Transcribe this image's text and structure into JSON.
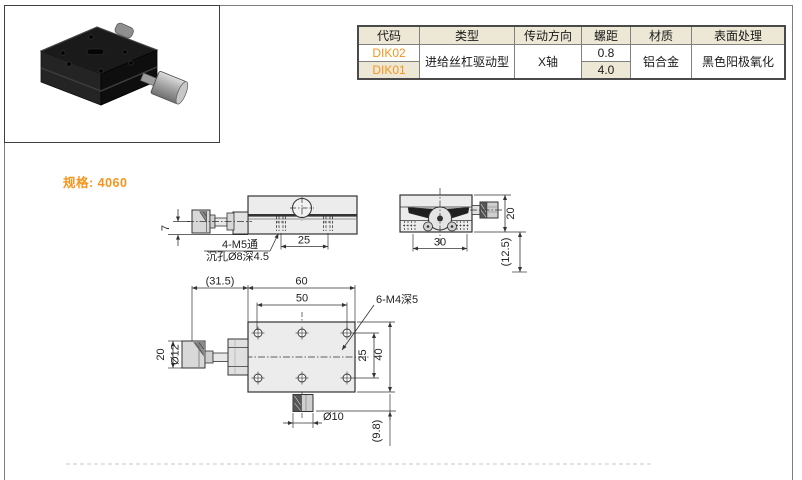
{
  "page": {
    "spec_label": "规格: 4060"
  },
  "spec_table": {
    "headers": [
      "代码",
      "类型",
      "传动方向",
      "螺距",
      "材质",
      "表面处理"
    ],
    "rows": [
      {
        "code": "DIK02",
        "pitch": "0.8"
      },
      {
        "code": "DIK01",
        "pitch": "4.0"
      }
    ],
    "merged": {
      "type": "进给丝杠驱动型",
      "direction": "X轴",
      "material": "铝合金",
      "finish": "黑色阳极氧化"
    }
  },
  "drawings": {
    "side_view": {
      "dim_height": "7",
      "thread_note_line1": "4-M5通",
      "thread_note_line2": "沉孔Ø8深4.5",
      "dim_hole_spacing": "25"
    },
    "end_view": {
      "dim_width": "30",
      "dim_height": "20",
      "dim_ref": "(12.5)"
    },
    "plan_view": {
      "dim_knob_len_ref": "(31.5)",
      "dim_length": "60",
      "dim_hole_span": "50",
      "thread_note": "6-M4深5",
      "dim_hole_pitch": "25",
      "dim_width": "40",
      "dim_knob_len": "20",
      "dim_knob_dia": "Ø12",
      "dim_lock_dia": "Ø10",
      "dim_ref": "(9.8)"
    }
  },
  "colors": {
    "accent": "#f7941d",
    "table_beige": "#ece8d5",
    "drawing_line": "#333333"
  }
}
